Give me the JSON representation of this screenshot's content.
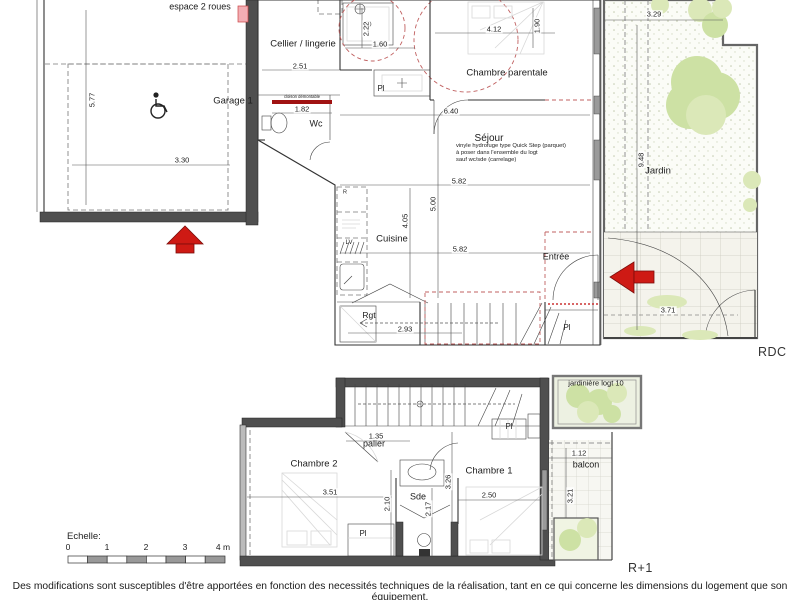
{
  "title": "Plan de logement - RDC et R+1",
  "footer": {
    "text": "Des modifications sont susceptibles d'être apportées en fonction des necessités techniques de la réalisation, tant en ce qui concerne les dimensions du logement que son équipement."
  },
  "colors": {
    "wall": "#4f4f4f",
    "accent_red": "#ce1a14",
    "vegetation": "#cde1a4",
    "marker_pink": "#f2aeb4"
  },
  "rdc": {
    "floor_label": "RDC",
    "note": "vinyle hydrofuge type Quick Step (parquet)\nà poser dans l'ensemble du logt\nsauf wc/sde (carrelage)",
    "room_labels": [
      {
        "text": "espace 2 roues",
        "x": 200,
        "y": 7,
        "size": 9
      },
      {
        "text": "Garage 1",
        "x": 233,
        "y": 101
      },
      {
        "text": "Cellier / lingerie",
        "x": 303,
        "y": 44
      },
      {
        "text": "Wc",
        "x": 316,
        "y": 124,
        "size": 9
      },
      {
        "text": "Chambre parentale",
        "x": 507,
        "y": 73
      },
      {
        "text": "Séjour",
        "x": 489,
        "y": 139,
        "size": 10
      },
      {
        "text": "Cuisine",
        "x": 392,
        "y": 239
      },
      {
        "text": "Entrée",
        "x": 556,
        "y": 257,
        "size": 9
      },
      {
        "text": "Rgt",
        "x": 369,
        "y": 315,
        "size": 8.5
      },
      {
        "text": "Pl",
        "x": 381,
        "y": 89,
        "size": 8
      },
      {
        "text": "Pl",
        "x": 567,
        "y": 328,
        "size": 8
      },
      {
        "text": "Jardin",
        "x": 658,
        "y": 171
      },
      {
        "text": "LV",
        "x": 349,
        "y": 243,
        "size": 6
      },
      {
        "text": "R",
        "x": 345,
        "y": 193,
        "size": 5.5
      },
      {
        "text": "cloison démontable",
        "x": 302,
        "y": 97,
        "size": 4.2
      }
    ],
    "dims": [
      {
        "v": "5.77",
        "x": 92,
        "y": 100,
        "rot": true
      },
      {
        "v": "3.30",
        "x": 182,
        "y": 160
      },
      {
        "v": "2.51",
        "x": 300,
        "y": 66
      },
      {
        "v": "1.82",
        "x": 302,
        "y": 109
      },
      {
        "v": "2.22",
        "x": 366,
        "y": 29,
        "rot": true
      },
      {
        "v": "1.60",
        "x": 380,
        "y": 44
      },
      {
        "v": "4.12",
        "x": 494,
        "y": 29
      },
      {
        "v": "1.90",
        "x": 537,
        "y": 26,
        "rot": true
      },
      {
        "v": "6.40",
        "x": 451,
        "y": 111
      },
      {
        "v": "5.82",
        "x": 459,
        "y": 181
      },
      {
        "v": "5.00",
        "x": 433,
        "y": 204,
        "rot": true
      },
      {
        "v": "4.05",
        "x": 405,
        "y": 221,
        "rot": true
      },
      {
        "v": "5.82",
        "x": 460,
        "y": 249
      },
      {
        "v": "2.93",
        "x": 405,
        "y": 329
      },
      {
        "v": "3.29",
        "x": 654,
        "y": 14
      },
      {
        "v": "9.48",
        "x": 641,
        "y": 160,
        "rot": true
      },
      {
        "v": "3.71",
        "x": 668,
        "y": 310
      }
    ]
  },
  "r1": {
    "floor_label": "R+1",
    "room_labels": [
      {
        "text": "Chambre 2",
        "x": 314,
        "y": 464
      },
      {
        "text": "palier",
        "x": 374,
        "y": 444,
        "size": 9
      },
      {
        "text": "Sde",
        "x": 418,
        "y": 497,
        "size": 9
      },
      {
        "text": "Chambre 1",
        "x": 489,
        "y": 471
      },
      {
        "text": "balcon",
        "x": 586,
        "y": 465,
        "size": 9
      },
      {
        "text": "jardinière logt 10",
        "x": 596,
        "y": 383,
        "size": 7.5
      },
      {
        "text": "Pl",
        "x": 509,
        "y": 427,
        "size": 8
      },
      {
        "text": "Pl",
        "x": 363,
        "y": 534,
        "size": 8
      }
    ],
    "dims": [
      {
        "v": "1.35",
        "x": 376,
        "y": 436
      },
      {
        "v": "3.51",
        "x": 330,
        "y": 492
      },
      {
        "v": "2.10",
        "x": 387,
        "y": 504,
        "rot": true
      },
      {
        "v": "2.17",
        "x": 428,
        "y": 509,
        "rot": true
      },
      {
        "v": "3.26",
        "x": 448,
        "y": 482,
        "rot": true
      },
      {
        "v": "2.50",
        "x": 489,
        "y": 495
      },
      {
        "v": "1.12",
        "x": 579,
        "y": 453
      },
      {
        "v": "3.21",
        "x": 570,
        "y": 496,
        "rot": true
      }
    ]
  },
  "scale": {
    "label": "Echelle:",
    "ticks": [
      {
        "t": "0",
        "x": 68
      },
      {
        "t": "1",
        "x": 107
      },
      {
        "t": "2",
        "x": 146
      },
      {
        "t": "3",
        "x": 185
      },
      {
        "t": "4 m",
        "x": 223
      }
    ]
  }
}
